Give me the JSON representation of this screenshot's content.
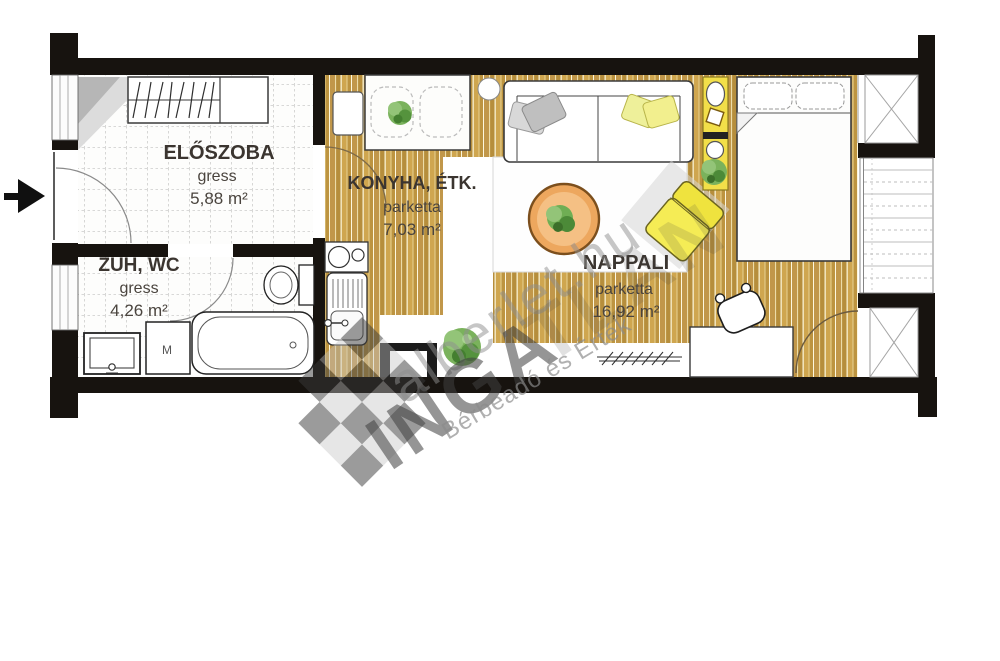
{
  "floorplan": {
    "rooms": [
      {
        "name": "ELŐSZOBA",
        "floor": "gress",
        "area": "5,88 m²"
      },
      {
        "name": "ZUH, WC",
        "floor": "gress",
        "area": "4,26 m²"
      },
      {
        "name": "KONYHA, ÉTK.",
        "floor": "parketta",
        "area": "7,03 m²"
      },
      {
        "name": "NAPPALI",
        "floor": "parketta",
        "area": "16,92 m²"
      }
    ],
    "appliance_labels": {
      "washing_machine": "M"
    },
    "colors": {
      "wall": "#17130f",
      "parquet": "#c79f4a",
      "accent_yellow": "#f2e24d",
      "table_orange": "#eda75e",
      "plant_green": "#6fae54"
    }
  },
  "watermark": {
    "site": "alberlet.hu",
    "word_bold": "INGA",
    "word_faint": "TLAN",
    "tagline": "Bérbeadó és Érték"
  }
}
